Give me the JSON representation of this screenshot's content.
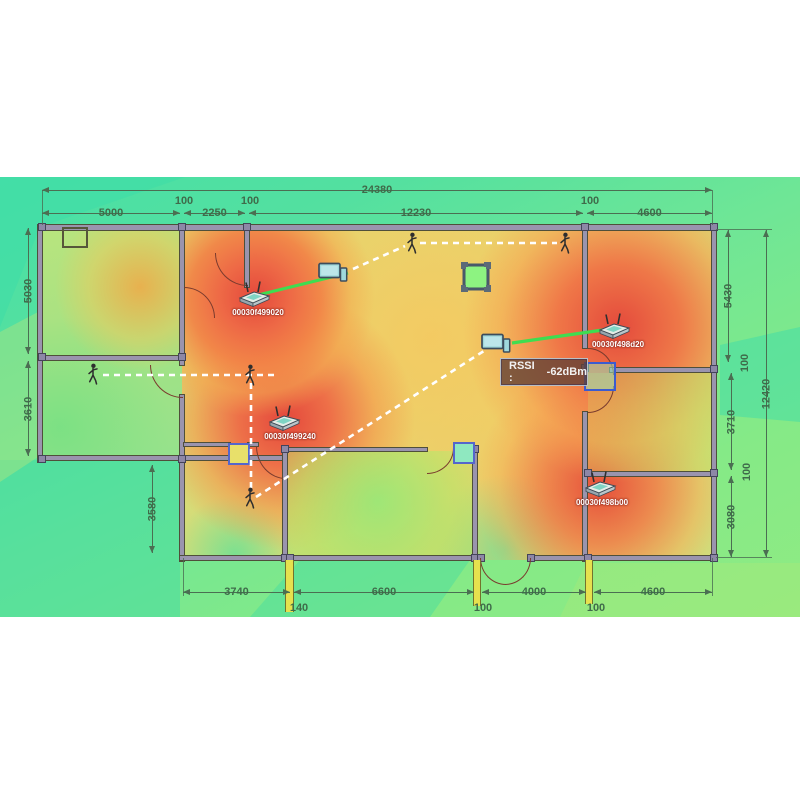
{
  "title": "WiFi coverage floor plan simulation",
  "tooltip": {
    "label": "RSSI :",
    "value": "-62dBm"
  },
  "access_points": [
    {
      "mac": "00030f499020"
    },
    {
      "mac": "00030f498d20"
    },
    {
      "mac": "00030f499240"
    },
    {
      "mac": "00030f498b00"
    }
  ],
  "dimensions": {
    "top_total": "24380",
    "top_a": "5000",
    "top_b": "100",
    "top_c": "2250",
    "top_d": "100",
    "top_e": "12230",
    "top_f": "100",
    "top_g": "4600",
    "left_a": "5030",
    "left_b": "3610",
    "left_c": "3580",
    "right_a": "5430",
    "right_b": "100",
    "right_c": "3710",
    "right_d": "100",
    "right_e": "3080",
    "right_total": "12420",
    "bot_a": "3740",
    "bot_b": "140",
    "bot_c": "6600",
    "bot_d": "100",
    "bot_e": "4000",
    "bot_f": "100",
    "bot_g": "4600"
  },
  "colors": {
    "heat_hot": "#e4483c",
    "heat_warm": "#f0a055",
    "heat_mild": "#ddd973",
    "cool_green": "#55dfa0",
    "teal": "#3edcae",
    "link_green": "#3fdd50",
    "path_white": "#ffffff",
    "dim_text": "#3f6b4a",
    "ap_label_text": "#ffffff",
    "selection_blue": "#3b5bd0"
  }
}
